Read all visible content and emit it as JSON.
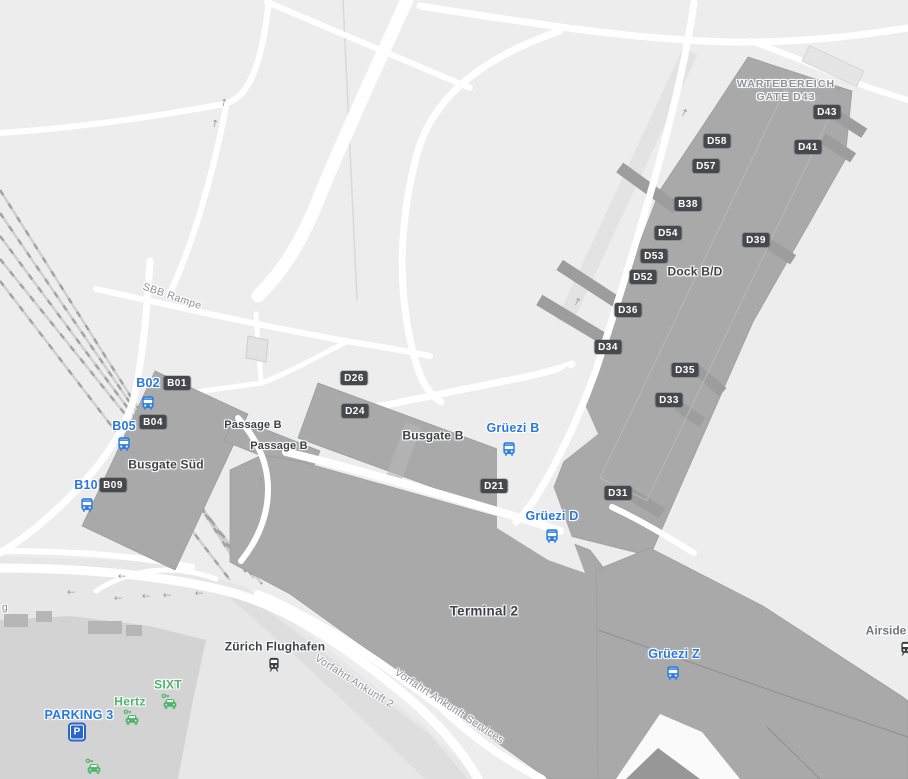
{
  "map": {
    "colors": {
      "background": "#ededed",
      "building_gray": "#a9a9a9",
      "road_white": "#ffffff",
      "badge_bg": "#46484b",
      "transit_blue": "#2a78dd",
      "bus_icon_blue": "#2e7fe0",
      "parking_blue": "#2a66c8",
      "rental_green": "#4db36d",
      "label_dark": "#3f4245",
      "label_gray": "#8d9095"
    },
    "area_labels": [
      {
        "name": "wartebereich-gate-d43-label",
        "text": "WARTEBEREICH\nGATE D43",
        "x": 786,
        "y": 91,
        "cls": "waiting",
        "rot": 0
      },
      {
        "name": "dock-bd-label",
        "text": "Dock B/D",
        "x": 695,
        "y": 272,
        "cls": "dark",
        "rot": 0
      },
      {
        "name": "busgate-b-label",
        "text": "Busgate B",
        "x": 433,
        "y": 436,
        "cls": "dark",
        "rot": 0
      },
      {
        "name": "busgate-sued-label",
        "text": "Busgate Süd",
        "x": 166,
        "y": 465,
        "cls": "dark",
        "rot": 0
      },
      {
        "name": "passage-b-label-1",
        "text": "Passage B",
        "x": 253,
        "y": 426,
        "cls": "dark sm",
        "rot": 0
      },
      {
        "name": "passage-b-label-2",
        "text": "Passage B",
        "x": 279,
        "y": 447,
        "cls": "dark sm",
        "rot": 0
      },
      {
        "name": "terminal-2-label",
        "text": "Terminal 2",
        "x": 484,
        "y": 612,
        "cls": "dark lg",
        "rot": 0
      },
      {
        "name": "airside-label",
        "text": "Airside",
        "x": 886,
        "y": 631,
        "cls": "gray",
        "rot": 0
      },
      {
        "name": "sbb-rampe-road-label",
        "text": "SBB Rampe",
        "x": 172,
        "y": 297,
        "cls": "roadlbl",
        "rot": 19
      },
      {
        "name": "vorfahrt-ankunft-2-road-label",
        "text": "Vorfahrt Ankunft 2",
        "x": 354,
        "y": 682,
        "cls": "roadlbl",
        "rot": 32
      },
      {
        "name": "vorfahrt-ankunft-services-road-label",
        "text": "Vorfahrt Ankunft Services",
        "x": 449,
        "y": 707,
        "cls": "roadlbl",
        "rot": 33
      },
      {
        "name": "street-label-partial",
        "text": "g",
        "x": 5,
        "y": 608,
        "cls": "roadlbl",
        "rot": 0
      }
    ],
    "gate_badges": [
      {
        "text": "D43",
        "x": 827,
        "y": 112
      },
      {
        "text": "D41",
        "x": 808,
        "y": 147
      },
      {
        "text": "D58",
        "x": 717,
        "y": 141
      },
      {
        "text": "D57",
        "x": 706,
        "y": 166
      },
      {
        "text": "B38",
        "x": 688,
        "y": 204
      },
      {
        "text": "D54",
        "x": 668,
        "y": 233
      },
      {
        "text": "D39",
        "x": 756,
        "y": 240
      },
      {
        "text": "D53",
        "x": 654,
        "y": 256
      },
      {
        "text": "D52",
        "x": 643,
        "y": 277
      },
      {
        "text": "D36",
        "x": 628,
        "y": 310
      },
      {
        "text": "D34",
        "x": 608,
        "y": 347
      },
      {
        "text": "D35",
        "x": 685,
        "y": 370
      },
      {
        "text": "D33",
        "x": 669,
        "y": 400
      },
      {
        "text": "D26",
        "x": 354,
        "y": 378
      },
      {
        "text": "D24",
        "x": 355,
        "y": 411
      },
      {
        "text": "D21",
        "x": 494,
        "y": 486
      },
      {
        "text": "D31",
        "x": 618,
        "y": 493
      },
      {
        "text": "B01",
        "x": 177,
        "y": 383
      },
      {
        "text": "B04",
        "x": 153,
        "y": 422
      },
      {
        "text": "B09",
        "x": 113,
        "y": 485
      }
    ],
    "bus_stops": [
      {
        "label": "B02",
        "tx": 148,
        "ty": 384,
        "ix": 148,
        "iy": 403
      },
      {
        "label": "B05",
        "tx": 124,
        "ty": 427,
        "ix": 124,
        "iy": 444
      },
      {
        "label": "B10",
        "tx": 86,
        "ty": 486,
        "ix": 87,
        "iy": 505
      },
      {
        "label": "Grüezi B",
        "tx": 513,
        "ty": 429,
        "ix": 509,
        "iy": 449
      },
      {
        "label": "Grüezi D",
        "tx": 552,
        "ty": 517,
        "ix": 552,
        "iy": 536
      },
      {
        "label": "Grüezi Z",
        "tx": 674,
        "ty": 655,
        "ix": 673,
        "iy": 673
      }
    ],
    "train_stations": [
      {
        "label": "Zürich Flughafen",
        "tx": 275,
        "ty": 647,
        "ix": 274,
        "iy": 665
      },
      {
        "label": "",
        "tx": 0,
        "ty": 0,
        "ix": 906,
        "iy": 649
      }
    ],
    "car_rentals": [
      {
        "label": "Hertz",
        "tx": 130,
        "ty": 702,
        "ix": 131,
        "iy": 717
      },
      {
        "label": "SIXT",
        "tx": 168,
        "ty": 685,
        "ix": 169,
        "iy": 701
      },
      {
        "label": "",
        "tx": 0,
        "ty": 0,
        "ix": 93,
        "iy": 766
      }
    ],
    "parking": {
      "label": "PARKING 3",
      "tx": 79,
      "ty": 716,
      "ix": 77,
      "iy": 732,
      "icon_letter": "P"
    }
  }
}
